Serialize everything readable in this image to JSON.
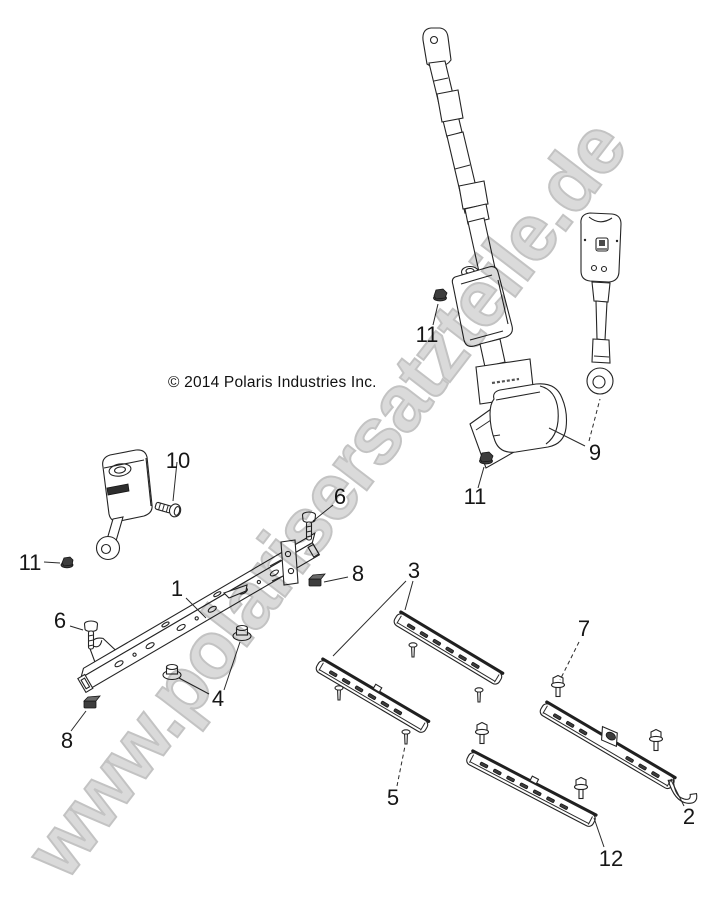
{
  "copyright": "© 2014 Polaris Industries Inc.",
  "watermark": {
    "text": "www.polarisersatzteile.de"
  },
  "colors": {
    "background": "#ffffff",
    "line_art": "#242424",
    "watermark_fill": "#dadada",
    "watermark_outline": "#c3c3c3"
  },
  "callouts": [
    {
      "number": "10"
    },
    {
      "number": "11"
    },
    {
      "number": "6"
    },
    {
      "number": "8"
    },
    {
      "number": "1"
    },
    {
      "number": "4"
    },
    {
      "number": "6"
    },
    {
      "number": "8"
    },
    {
      "number": "3"
    },
    {
      "number": "11"
    },
    {
      "number": "11"
    },
    {
      "number": "9"
    },
    {
      "number": "7"
    },
    {
      "number": "5"
    },
    {
      "number": "12"
    },
    {
      "number": "2"
    }
  ]
}
